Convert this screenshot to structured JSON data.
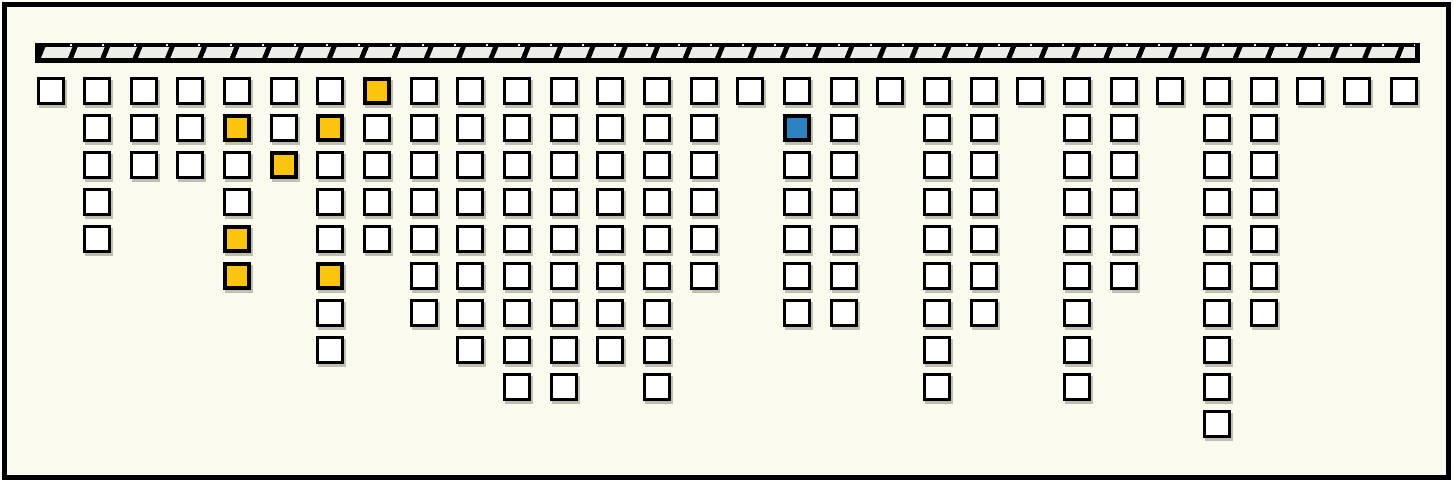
{
  "diagram": {
    "description": "icicle-style hanging-squares diagram: 30 columns of outlined square cells suspended from a hatched ceiling bar; some cells highlighted yellow, one highlighted blue",
    "canvas": {
      "width": 1454,
      "height": 483
    },
    "colors": {
      "background": "#fbfaee",
      "frame": "#000000",
      "cell_default": "#ffffff",
      "yellow": "#fbc40e",
      "blue": "#2e82c1",
      "bar_fill": "#ecece8",
      "hatch": "#000000",
      "shadow": "rgba(120,118,100,0.45)"
    },
    "ceiling_bar": {
      "x": 35,
      "y": 43,
      "width": 1385,
      "height": 20,
      "hatch_angle_deg": 112,
      "hatch_black_px": 5,
      "hatch_period_px": 30
    },
    "grid": {
      "col_start_x": 36.5,
      "col_pitch": 46.66,
      "row_start_y": 77,
      "row_pitch": 37,
      "cell_size": 28,
      "num_columns": 30,
      "max_rows": 10
    },
    "columns": [
      {
        "count": 1,
        "marks": {}
      },
      {
        "count": 5,
        "marks": {}
      },
      {
        "count": 3,
        "marks": {}
      },
      {
        "count": 3,
        "marks": {}
      },
      {
        "count": 6,
        "marks": {
          "2": "yellow",
          "5": "yellow",
          "6": "yellow"
        }
      },
      {
        "count": 3,
        "marks": {
          "3": "yellow"
        }
      },
      {
        "count": 8,
        "marks": {
          "2": "yellow",
          "6": "yellow"
        }
      },
      {
        "count": 5,
        "marks": {
          "1": "yellow"
        }
      },
      {
        "count": 7,
        "marks": {}
      },
      {
        "count": 8,
        "marks": {}
      },
      {
        "count": 9,
        "marks": {}
      },
      {
        "count": 9,
        "marks": {}
      },
      {
        "count": 8,
        "marks": {}
      },
      {
        "count": 9,
        "marks": {}
      },
      {
        "count": 6,
        "marks": {}
      },
      {
        "count": 1,
        "marks": {}
      },
      {
        "count": 7,
        "marks": {
          "2": "blue"
        }
      },
      {
        "count": 7,
        "marks": {}
      },
      {
        "count": 1,
        "marks": {}
      },
      {
        "count": 9,
        "marks": {}
      },
      {
        "count": 7,
        "marks": {}
      },
      {
        "count": 1,
        "marks": {}
      },
      {
        "count": 9,
        "marks": {}
      },
      {
        "count": 6,
        "marks": {}
      },
      {
        "count": 1,
        "marks": {}
      },
      {
        "count": 10,
        "marks": {}
      },
      {
        "count": 7,
        "marks": {}
      },
      {
        "count": 1,
        "marks": {}
      },
      {
        "count": 1,
        "marks": {}
      },
      {
        "count": 1,
        "marks": {}
      }
    ]
  }
}
